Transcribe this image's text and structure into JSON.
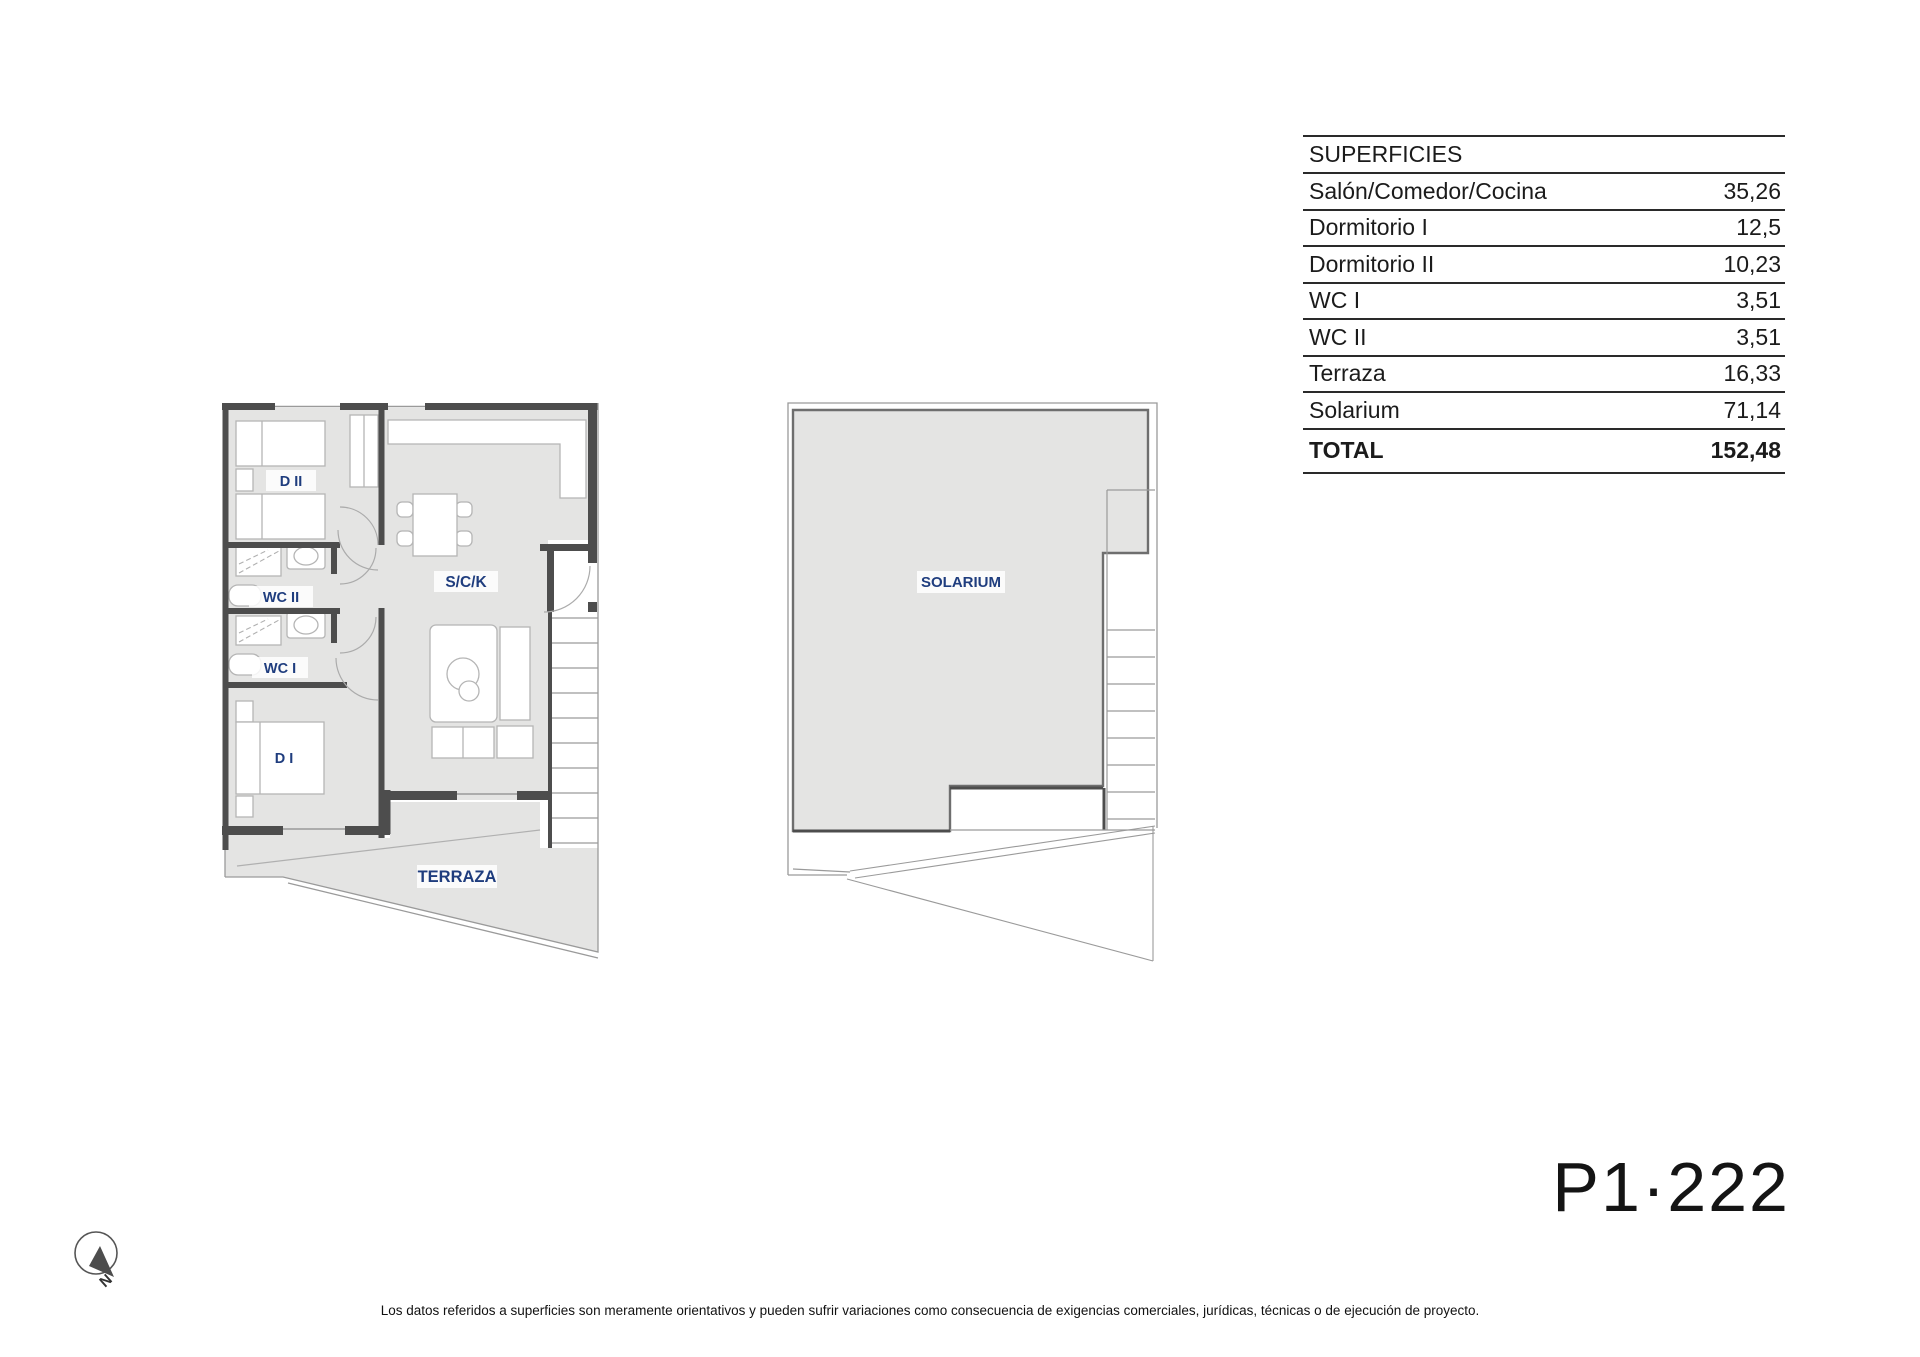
{
  "surfaces_table": {
    "title": "SUPERFICIES",
    "rows": [
      {
        "label": "Salón/Comedor/Cocina",
        "value": "35,26"
      },
      {
        "label": "Dormitorio I",
        "value": "12,5"
      },
      {
        "label": "Dormitorio II",
        "value": "10,23"
      },
      {
        "label": "WC I",
        "value": "3,51"
      },
      {
        "label": "WC II",
        "value": "3,51"
      },
      {
        "label": "Terraza",
        "value": "16,33"
      },
      {
        "label": "Solarium",
        "value": "71,14"
      }
    ],
    "total": {
      "label": "TOTAL",
      "value": "152,48"
    }
  },
  "plan_apartment": {
    "rooms": {
      "d2": "D II",
      "wc2": "WC II",
      "wc1": "WC I",
      "d1": "D I",
      "sck": "S/C/K",
      "terraza": "TERRAZA"
    }
  },
  "plan_solarium": {
    "label": "SOLARIUM"
  },
  "compass": {
    "north": "N"
  },
  "unit_code": "P1·222",
  "disclaimer": "Los datos referidos a superficies son meramente orientativos y pueden sufrir variaciones como consecuencia de exigencias comerciales, jurídicas, técnicas o de ejecución de proyecto.",
  "colors": {
    "floor": "#e4e4e3",
    "wall": "#4d4d4d",
    "thin_line": "#9a9a9a",
    "furniture_line": "#b5b5b5",
    "room_label": "#1f3d7e"
  }
}
